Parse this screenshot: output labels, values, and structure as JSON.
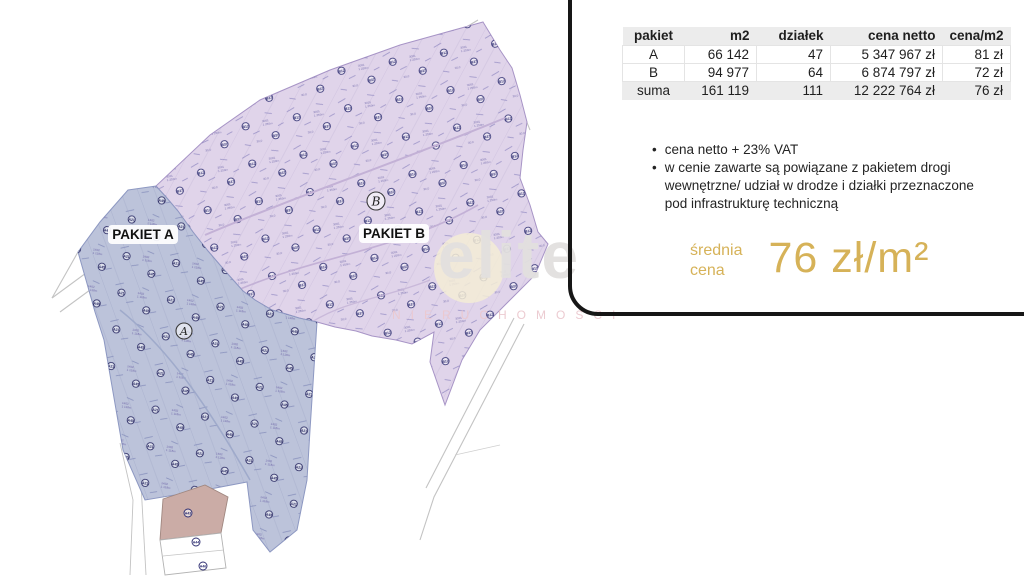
{
  "panel": {
    "table": {
      "columns": [
        "pakiet",
        "m2",
        "działek",
        "cena netto",
        "cena/m2"
      ],
      "rows": [
        {
          "pakiet": "A",
          "m2": "66 142",
          "dzialek": "47",
          "cena_netto": "5 347 967 zł",
          "cena_m2": "81 zł"
        },
        {
          "pakiet": "B",
          "m2": "94 977",
          "dzialek": "64",
          "cena_netto": "6 874 797 zł",
          "cena_m2": "72 zł"
        },
        {
          "pakiet": "suma",
          "m2": "161 119",
          "dzialek": "111",
          "cena_netto": "12 222 764 zł",
          "cena_m2": "76 zł"
        }
      ]
    },
    "bullets": {
      "marker": "•",
      "items": [
        "cena netto + 23% VAT",
        "w cenie zawarte są powiązane z pakietem drogi wewnętrzne/ udział w drodze i działki przeznaczone pod infrastrukturę techniczną"
      ]
    },
    "average": {
      "label_line1": "średnia",
      "label_line2": "cena",
      "value": "76 zł/m²",
      "color": "#d6b258"
    }
  },
  "map": {
    "labels": {
      "pakiet_a": "PAKIET A",
      "pakiet_b": "PAKIET B",
      "circle_a": "A",
      "circle_b": "B"
    },
    "colors": {
      "region_a": "#bcc3da",
      "region_b": "#e0d4ea",
      "parcel_tan": "#cbaca6",
      "marker_dark": "#2c2c70",
      "marker_light": "#8a82be"
    }
  },
  "watermark": {
    "text": "elite",
    "subtext": "NIERUCHOMOŚCI"
  }
}
